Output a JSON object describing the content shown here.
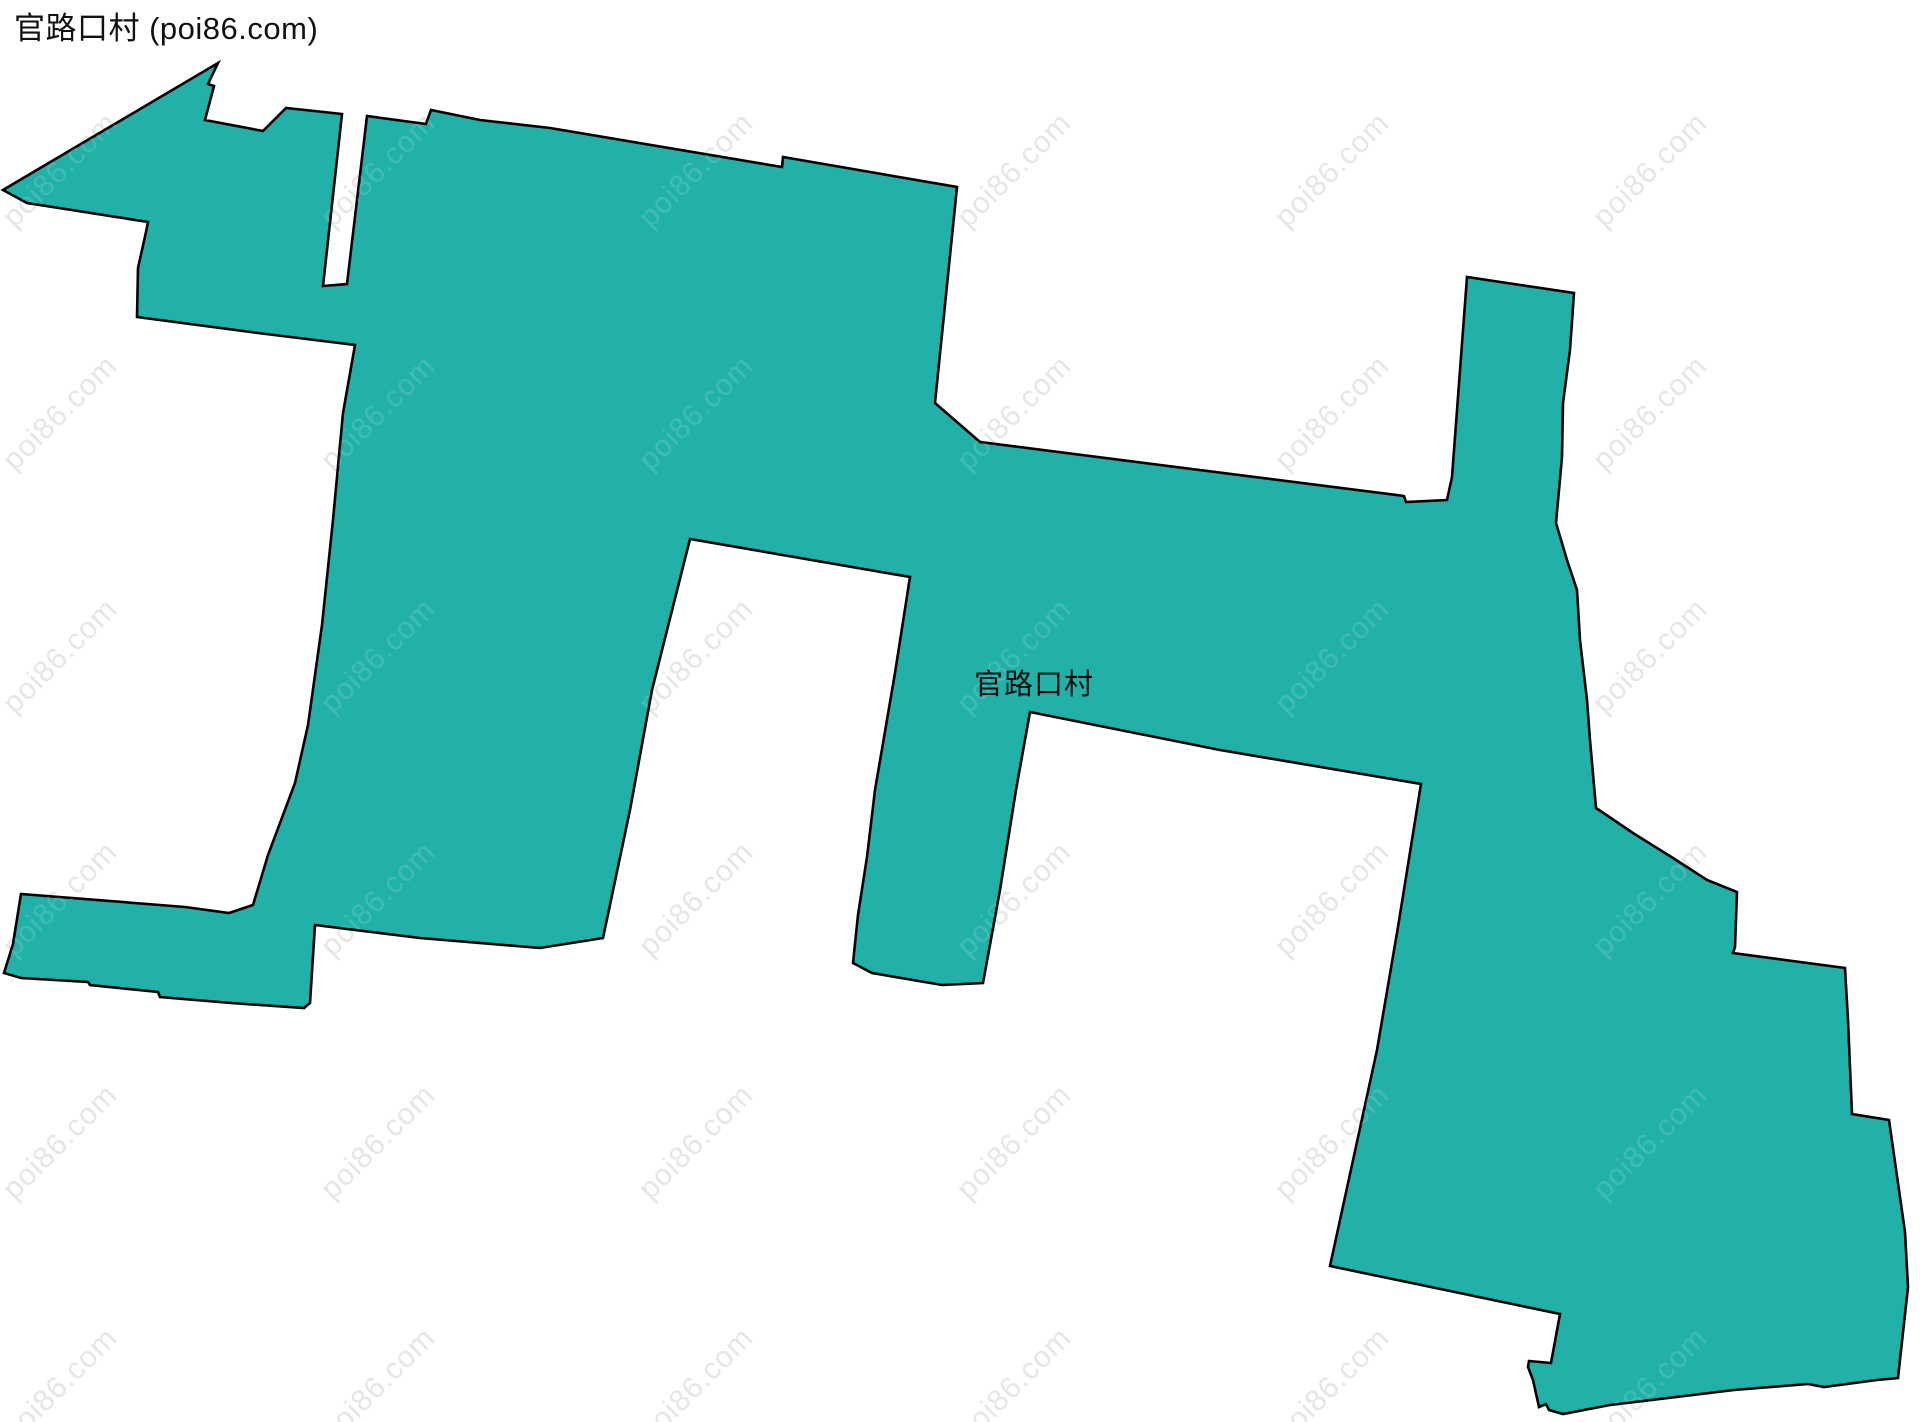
{
  "header": {
    "title": "官路口村 (poi86.com)"
  },
  "map": {
    "village_label": "官路口村",
    "boundary_name": "官路口村",
    "fill_color": "#21b1a9",
    "stroke_color": "#000000",
    "stroke_width": 2.6,
    "background_color": "#ffffff",
    "boundary_points": [
      [
        3,
        190
      ],
      [
        27,
        203
      ],
      [
        148,
        222
      ],
      [
        146,
        232
      ],
      [
        138,
        268
      ],
      [
        137,
        317
      ],
      [
        258,
        333
      ],
      [
        355,
        345
      ],
      [
        343,
        413
      ],
      [
        333,
        520
      ],
      [
        322,
        625
      ],
      [
        308,
        725
      ],
      [
        295,
        783
      ],
      [
        268,
        855
      ],
      [
        253,
        905
      ],
      [
        229,
        913
      ],
      [
        185,
        907
      ],
      [
        21,
        894
      ],
      [
        13,
        944
      ],
      [
        4,
        973
      ],
      [
        21,
        978
      ],
      [
        88,
        982
      ],
      [
        90,
        985
      ],
      [
        158,
        992
      ],
      [
        160,
        997
      ],
      [
        231,
        1003
      ],
      [
        304,
        1008
      ],
      [
        310,
        1003
      ],
      [
        315,
        925
      ],
      [
        420,
        938
      ],
      [
        540,
        948
      ],
      [
        603,
        938
      ],
      [
        630,
        810
      ],
      [
        652,
        690
      ],
      [
        690,
        539
      ],
      [
        910,
        577
      ],
      [
        895,
        673
      ],
      [
        875,
        790
      ],
      [
        867,
        857
      ],
      [
        858,
        915
      ],
      [
        853,
        963
      ],
      [
        872,
        973
      ],
      [
        942,
        985
      ],
      [
        983,
        983
      ],
      [
        1000,
        890
      ],
      [
        1016,
        790
      ],
      [
        1030,
        712
      ],
      [
        1220,
        750
      ],
      [
        1421,
        784
      ],
      [
        1398,
        927
      ],
      [
        1377,
        1050
      ],
      [
        1330,
        1266
      ],
      [
        1560,
        1314
      ],
      [
        1551,
        1363
      ],
      [
        1529,
        1361
      ],
      [
        1528,
        1367
      ],
      [
        1533,
        1380
      ],
      [
        1539,
        1407
      ],
      [
        1546,
        1404
      ],
      [
        1549,
        1410
      ],
      [
        1563,
        1414
      ],
      [
        1610,
        1405
      ],
      [
        1734,
        1390
      ],
      [
        1808,
        1384
      ],
      [
        1824,
        1387
      ],
      [
        1877,
        1380
      ],
      [
        1898,
        1378
      ],
      [
        1908,
        1287
      ],
      [
        1905,
        1232
      ],
      [
        1889,
        1120
      ],
      [
        1852,
        1114
      ],
      [
        1848,
        1020
      ],
      [
        1845,
        968
      ],
      [
        1733,
        953
      ],
      [
        1735,
        947
      ],
      [
        1737,
        892
      ],
      [
        1707,
        880
      ],
      [
        1673,
        858
      ],
      [
        1633,
        833
      ],
      [
        1596,
        808
      ],
      [
        1590,
        740
      ],
      [
        1587,
        700
      ],
      [
        1580,
        640
      ],
      [
        1577,
        590
      ],
      [
        1567,
        560
      ],
      [
        1556,
        523
      ],
      [
        1562,
        457
      ],
      [
        1563,
        403
      ],
      [
        1570,
        350
      ],
      [
        1574,
        293
      ],
      [
        1467,
        277
      ],
      [
        1452,
        477
      ],
      [
        1447,
        500
      ],
      [
        1406,
        502
      ],
      [
        1404,
        496
      ],
      [
        980,
        442
      ],
      [
        935,
        403
      ],
      [
        957,
        187
      ],
      [
        783,
        157
      ],
      [
        782,
        167
      ],
      [
        550,
        128
      ],
      [
        480,
        120
      ],
      [
        431,
        110
      ],
      [
        426,
        124
      ],
      [
        367,
        116
      ],
      [
        347,
        284
      ],
      [
        323,
        286
      ],
      [
        342,
        114
      ],
      [
        286,
        108
      ],
      [
        263,
        131
      ],
      [
        205,
        120
      ],
      [
        214,
        86
      ],
      [
        208,
        84
      ],
      [
        218,
        63
      ]
    ]
  },
  "watermark": {
    "text": "poi86.com",
    "color_on_white": "#e6e6e6",
    "rotation_deg": -45,
    "grid": {
      "x0": 60,
      "dx": 318,
      "cols": 6,
      "y0": 170,
      "dy": 243,
      "rows": 6
    }
  }
}
